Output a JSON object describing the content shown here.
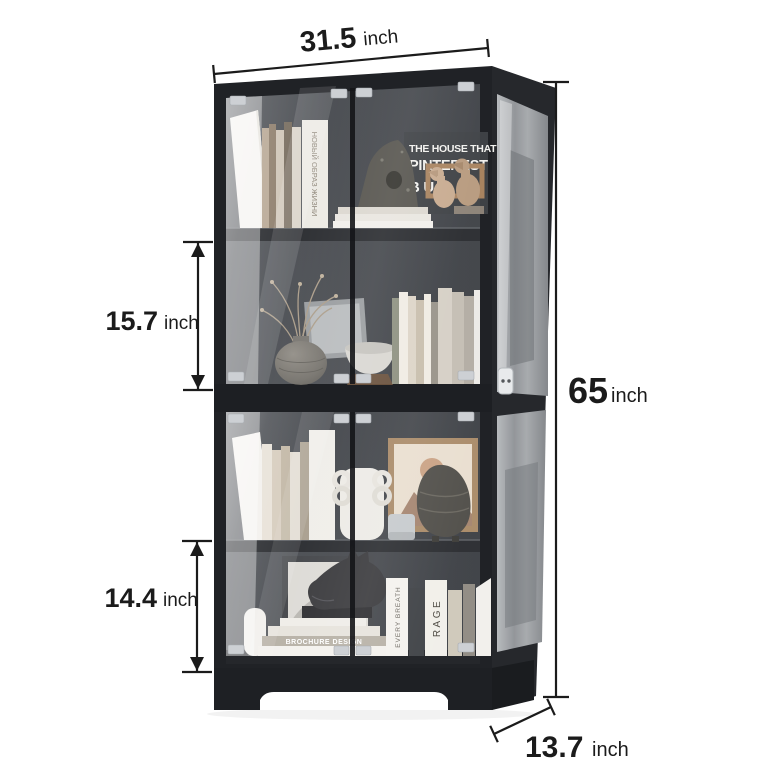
{
  "dimensions": {
    "width": {
      "value": "31.5",
      "unit": "inch"
    },
    "height": {
      "value": "65",
      "unit": "inch"
    },
    "upper_shelf": {
      "value": "15.7",
      "unit": "inch"
    },
    "lower_shelf": {
      "value": "14.4",
      "unit": "inch"
    },
    "depth": {
      "value": "13.7",
      "unit": "inch"
    }
  },
  "decor_text": {
    "poster": [
      "THE HOUSE THAT",
      "PINTEREST",
      "B U"
    ],
    "book_spine_cyrillic": "НОВЫЙ ОБРАЗ ЖИЗНИ",
    "book_stack": "BROCHURE DESIGN",
    "book_rage": "RAGE",
    "book_every_breath": "EVERY BREATH"
  },
  "colors": {
    "frame": "#202226",
    "side": "#26282c",
    "dimension": "#1b1b1b",
    "bracket": "#cdd0d4",
    "background": "#ffffff"
  }
}
